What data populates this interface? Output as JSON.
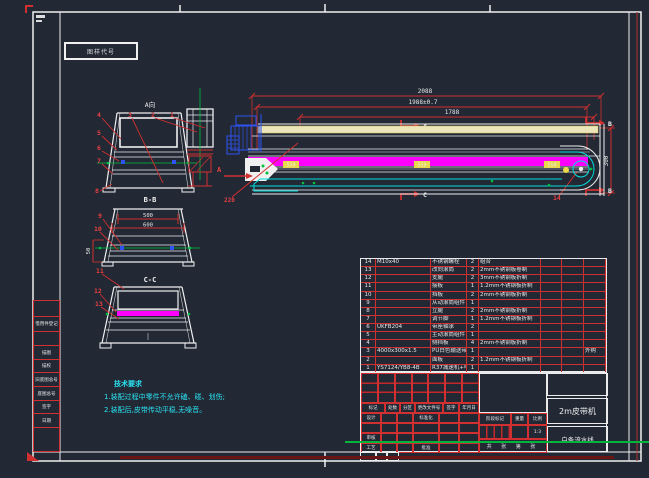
{
  "colors": {
    "background": "#222834",
    "line": "#e9e9e9",
    "red": "#d03030",
    "green": "#00c040",
    "magenta": "#ff00ff",
    "cyan": "#00dede",
    "cream": "#ece5ba",
    "yellow_tag": "#e8d84a",
    "blue": "#2e53f0"
  },
  "sheet": {
    "corner_label": "图样代号",
    "margin_labels": [
      "",
      "借用件登记",
      "",
      "描图",
      "描校",
      "旧底图总号",
      "底图总号",
      "签字",
      "日期",
      ""
    ]
  },
  "views": {
    "direction_label": "A向",
    "section_b": "B-B",
    "section_c": "C-C",
    "callouts": [
      "1",
      "2",
      "3",
      "4",
      "5",
      "6",
      "7",
      "8",
      "9",
      "10",
      "11",
      "12",
      "13",
      "14"
    ],
    "drive_note": "220"
  },
  "dims": {
    "overall": "2088",
    "toleranced": "1988±0.7",
    "inner": "1788",
    "width_top": "500",
    "width_bottom": "600",
    "leg": "50",
    "tail_height": "300",
    "belt_tags": [
      "550",
      "550",
      "550"
    ],
    "section_letter_c": "C",
    "section_letter_b": "B",
    "view_arrow": "A"
  },
  "notes": {
    "title": "技术要求",
    "items": [
      "1.装配过程中零件不允许磕、碰、划伤;",
      "2.装配后,皮带传动平稳,无噪音。"
    ]
  },
  "bom": {
    "rows": [
      [
        "14",
        "M10x40",
        "不锈钢螺栓",
        "2",
        "组合",
        "",
        "",
        ""
      ],
      [
        "13",
        "",
        "改向滚筒",
        "2",
        "2mm不锈钢板卷制",
        "",
        "",
        ""
      ],
      [
        "12",
        "",
        "支腿",
        "2",
        "3mm不锈钢板折制",
        "",
        "",
        ""
      ],
      [
        "11",
        "",
        "接板",
        "1",
        "1.2mm不锈钢板折制",
        "",
        "",
        ""
      ],
      [
        "10",
        "",
        "挡板",
        "2",
        "2mm不锈钢板折制",
        "",
        "",
        ""
      ],
      [
        "9",
        "",
        "从动滚筒组件",
        "1",
        "",
        "",
        "",
        ""
      ],
      [
        "8",
        "",
        "立腿",
        "2",
        "2mm不锈钢板折制",
        "",
        "",
        ""
      ],
      [
        "7",
        "",
        "调节脚",
        "1",
        "1.2mm不锈钢板折制",
        "",
        "",
        ""
      ],
      [
        "6",
        "UKFB204",
        "带座轴承",
        "2",
        "",
        "",
        "",
        ""
      ],
      [
        "5",
        "",
        "主动滚筒组件",
        "1",
        "",
        "",
        "",
        ""
      ],
      [
        "4",
        "",
        "侧挡板",
        "4",
        "2mm不锈钢板折制",
        "",
        "",
        ""
      ],
      [
        "3",
        "4000x300x1.5",
        "PU白色输送带",
        "1",
        "",
        "",
        "",
        "外购"
      ],
      [
        "2",
        "",
        "面板",
        "2",
        "1.2mm不锈钢板折制",
        "",
        "",
        ""
      ],
      [
        "1",
        "YS7124/YB8-4B",
        "R37减速机+电机组合",
        "1",
        "",
        "",
        "",
        ""
      ]
    ]
  },
  "title_block": {
    "change_header": [
      "标记",
      "处数",
      "分区",
      "更改文件号",
      "签字",
      "年月日"
    ],
    "design": "设计",
    "standardization": "标准化",
    "audit": "审核",
    "process": "工艺",
    "approve": "批准",
    "stage": "阶段标记",
    "weight": "重量",
    "scale": "比例",
    "scale_value": "1:3",
    "sheets": "共 张 第 张",
    "product": "2m皮带机",
    "project": "白条流水线"
  }
}
